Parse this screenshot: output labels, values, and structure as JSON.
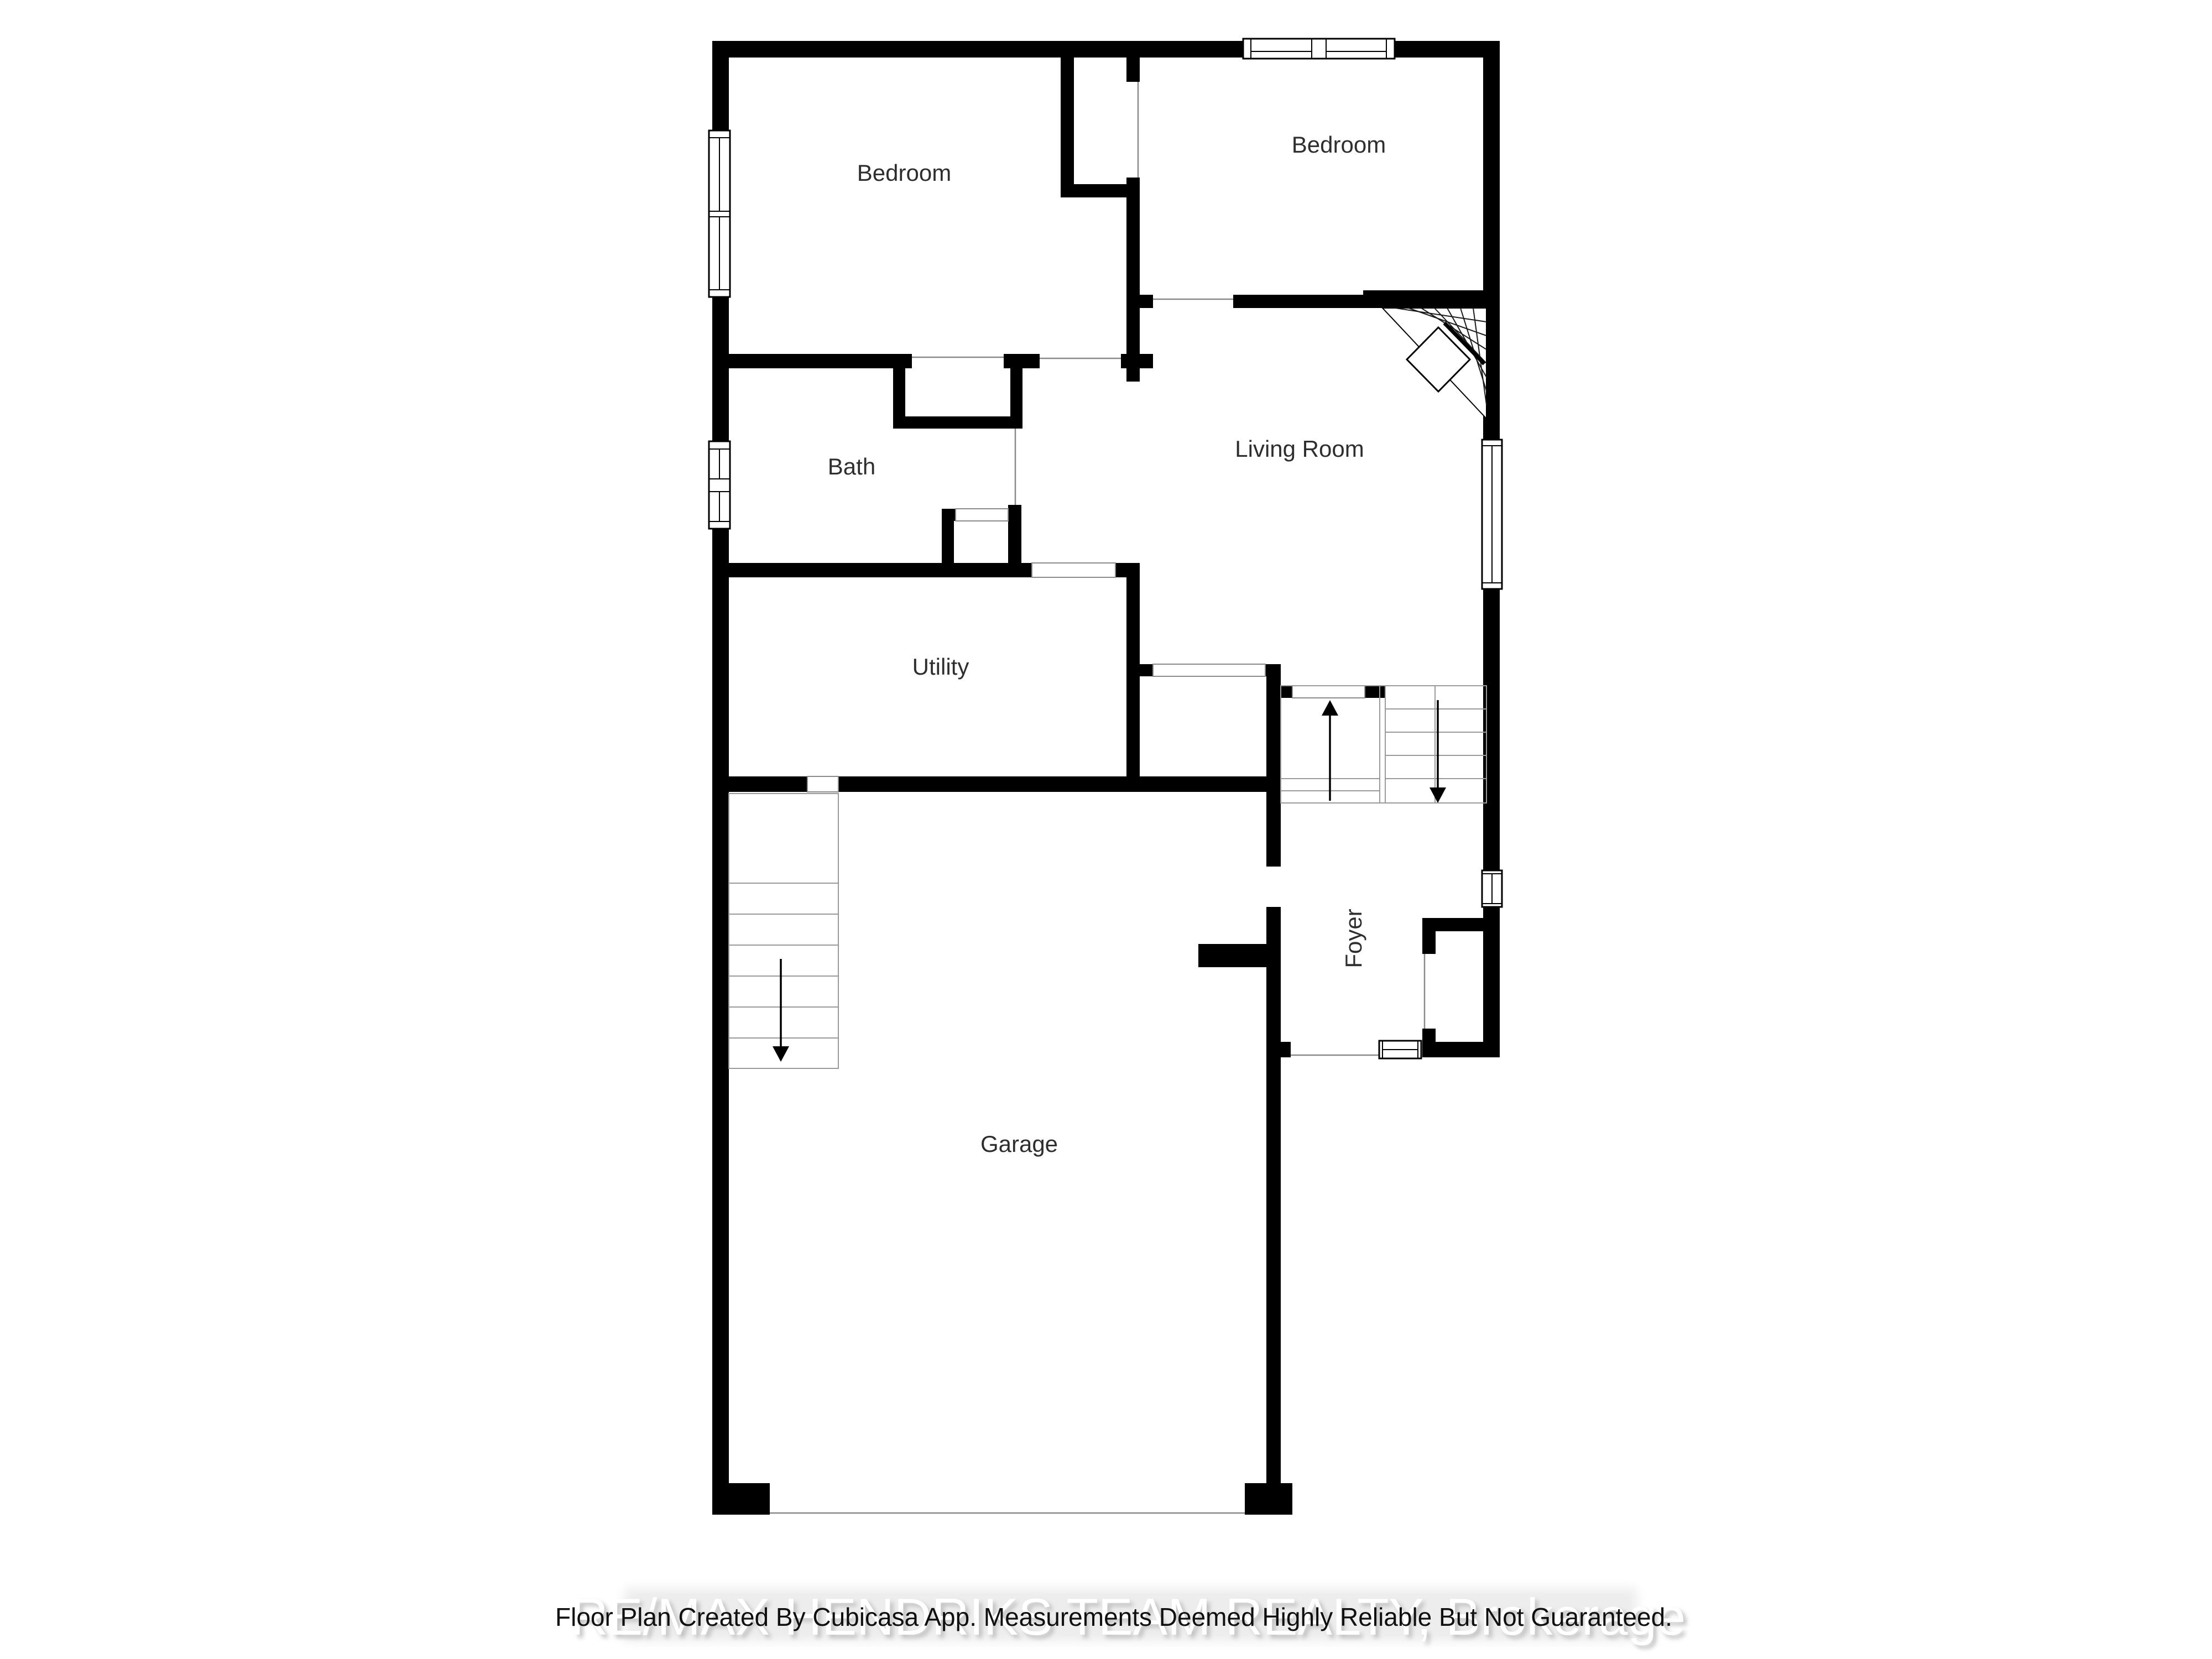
{
  "rooms": [
    {
      "id": "bedroom-left",
      "label": "Bedroom"
    },
    {
      "id": "bedroom-right",
      "label": "Bedroom"
    },
    {
      "id": "bath",
      "label": "Bath"
    },
    {
      "id": "living-room",
      "label": "Living Room"
    },
    {
      "id": "utility",
      "label": "Utility"
    },
    {
      "id": "foyer",
      "label": "Foyer"
    },
    {
      "id": "garage",
      "label": "Garage"
    }
  ],
  "stairs": {
    "main_up_icon": "up-arrow-icon",
    "main_down_icon": "down-arrow-icon",
    "basement_down_icon": "down-arrow-icon"
  },
  "footer": {
    "disclaimer": "Floor Plan Created By Cubicasa App. Measurements Deemed Highly Reliable But Not Guaranteed.",
    "watermark": "RE/MAX  HENDRIKS TEAM REALTY, Brokerage"
  },
  "colors": {
    "wall": "#000000",
    "thin_line": "#8a8a8a",
    "label": "#2e2e2e",
    "background": "#ffffff",
    "watermark_band": "#ededed",
    "watermark_text": "#ffffff",
    "watermark_shadow": "#c0c0c0",
    "disclaimer_text": "#101010"
  }
}
